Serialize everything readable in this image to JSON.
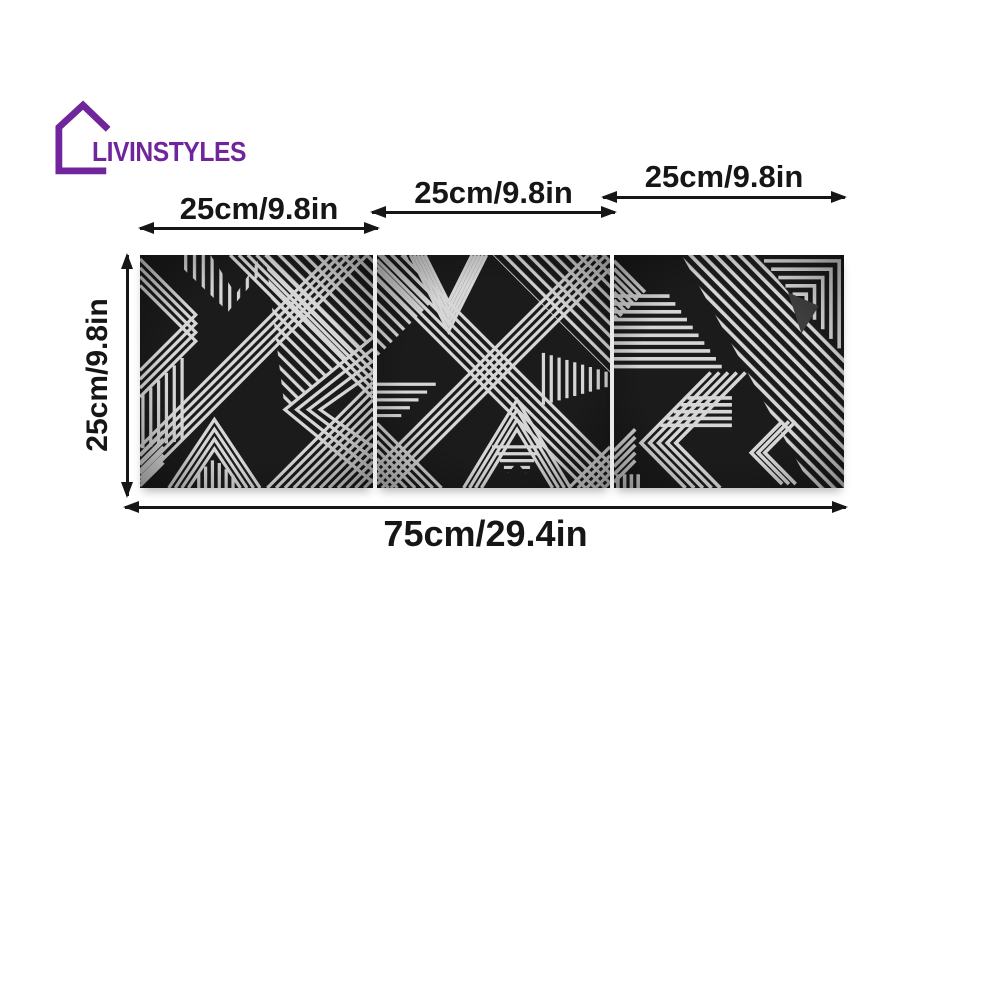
{
  "brand": {
    "name": "LIVINSTYLES",
    "logo_icon": "house-outline-icon",
    "color": "#70259c"
  },
  "dimensions": {
    "panel_width_labels": [
      "25cm/9.8in",
      "25cm/9.8in",
      "25cm/9.8in"
    ],
    "height_label": "25cm/9.8in",
    "total_width_label": "75cm/29.4in"
  },
  "panels": {
    "count": 3,
    "description": "three black square panels with white geometric line-art patterns"
  },
  "colors": {
    "panel_background": "#1b1b1b",
    "panel_line": "#d6d6d6",
    "annotation": "#161616",
    "page_background": "#ffffff",
    "brand": "#70259c"
  }
}
